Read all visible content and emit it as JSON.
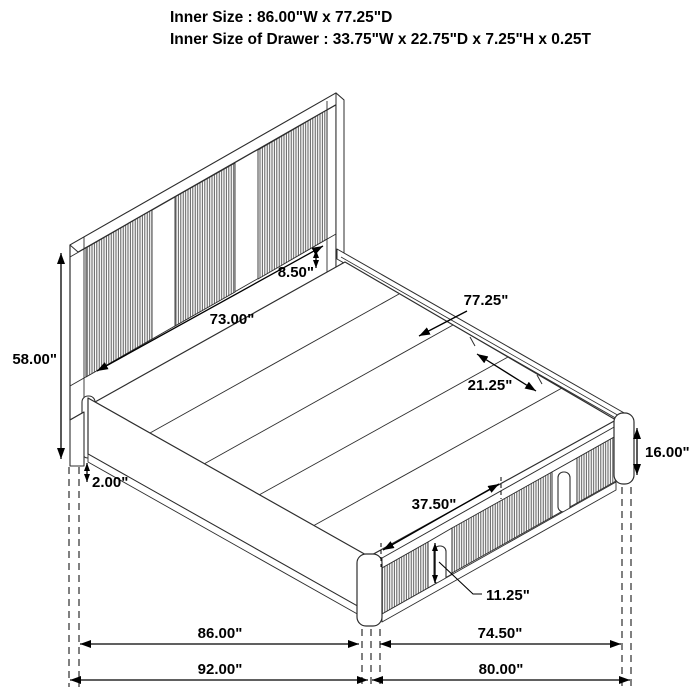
{
  "header": {
    "line1": "Inner Size : 86.00\"W x 77.25\"D",
    "line2": "Inner Size of Drawer : 33.75\"W x 22.75\"D x 7.25\"H x 0.25T"
  },
  "dimensions": {
    "headboard_height": "58.00\"",
    "headboard_panel_width": "73.00\"",
    "headboard_gap": "8.50\"",
    "platform_depth": "77.25\"",
    "rail_segment": "21.25\"",
    "footboard_height": "16.00\"",
    "base_clearance": "2.00\"",
    "drawer_front_width": "37.50\"",
    "drawer_front_height": "11.25\"",
    "inner_width": "86.00\"",
    "foot_inner_width": "74.50\"",
    "outer_length": "92.00\"",
    "outer_width": "80.00\""
  },
  "colors": {
    "line": "#000000",
    "structure_line": "#2e2e2e",
    "flute_stripe": "#474747",
    "background": "#ffffff"
  }
}
